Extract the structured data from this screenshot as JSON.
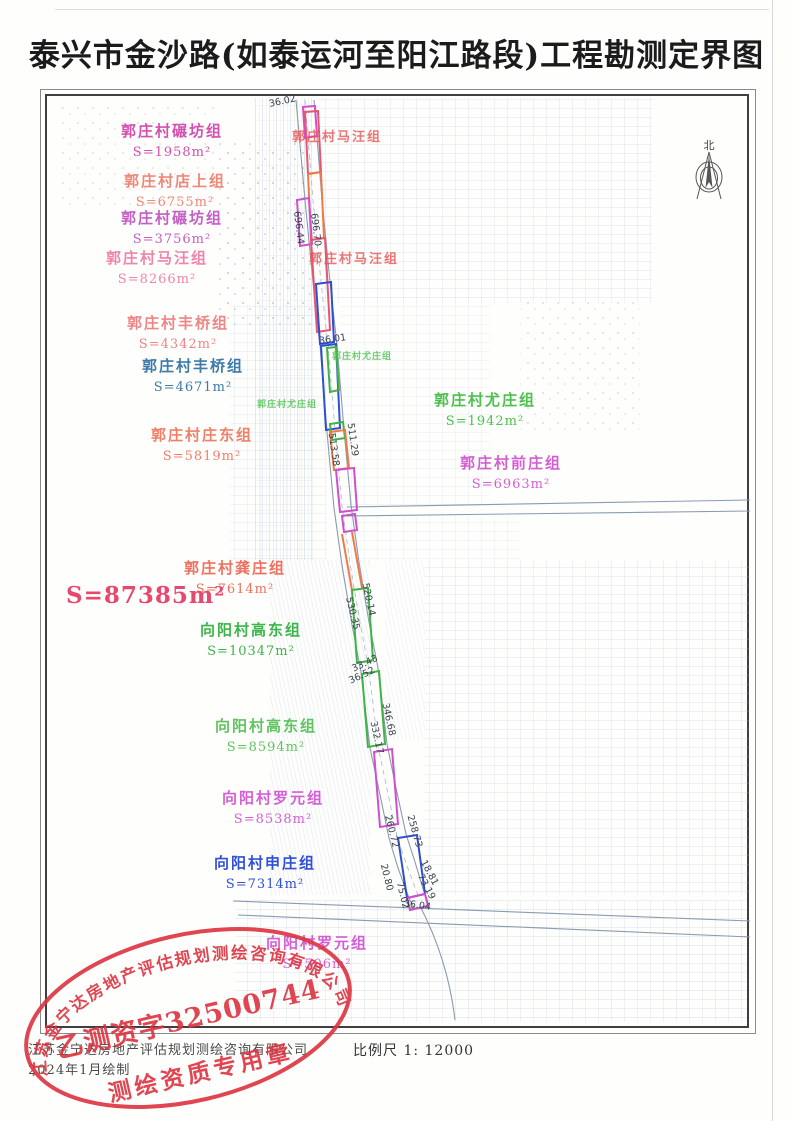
{
  "title": "泰兴市金沙路(如泰运河至阳江路段)工程勘测定界图",
  "north_label": "北",
  "total_area": {
    "text": "S=87385m²",
    "color": "#e8486e"
  },
  "footer": {
    "company": "江苏金宁达房地产评估规划测绘咨询有限公司",
    "date": "2024年1月绘制",
    "scale_label": "比例尺 1: 12000"
  },
  "stamp": {
    "arc_text": "江苏金宁达房地产评估规划测绘咨询有限公司",
    "center_text": "乙测资字32500744",
    "bottom_text": "测绘资质专用章",
    "color": "#dd3340"
  },
  "map": {
    "palette": {
      "magenta": "#cf4fcf",
      "red": "#e8556e",
      "orange": "#f07a45",
      "blue": "#2e4fd2",
      "green": "#41b344",
      "road": "#8a9bb0",
      "total": "#e8486e",
      "stamp": "#dd3340"
    },
    "area_labels": [
      {
        "name": "郭庄村碾坊组",
        "area": "S=1958m²",
        "color": "#d44fb0",
        "x": 172,
        "y": 120
      },
      {
        "name": "郭庄村店上组",
        "area": "S=6755m²",
        "color": "#ef8878",
        "x": 175,
        "y": 170
      },
      {
        "name": "郭庄村碾坊组",
        "area": "S=3756m²",
        "color": "#c45fc4",
        "x": 172,
        "y": 207
      },
      {
        "name": "郭庄村马汪组",
        "area": "S=8266m²",
        "color": "#ef85a8",
        "x": 157,
        "y": 247
      },
      {
        "name": "郭庄村丰桥组",
        "area": "S=4342m²",
        "color": "#ef8585",
        "x": 178,
        "y": 312
      },
      {
        "name": "郭庄村丰桥组",
        "area": "S=4671m²",
        "color": "#3d7ba8",
        "x": 193,
        "y": 355
      },
      {
        "name": "郭庄村庄东组",
        "area": "S=5819m²",
        "color": "#f0806a",
        "x": 202,
        "y": 424
      },
      {
        "name": "郭庄村龚庄组",
        "area": "S=7614m²",
        "color": "#f0705f",
        "x": 235,
        "y": 557
      },
      {
        "name": "向阳村高东组",
        "area": "S=10347m²",
        "color": "#3cb54a",
        "x": 251,
        "y": 619
      },
      {
        "name": "向阳村高东组",
        "area": "S=8594m²",
        "color": "#5fc45f",
        "x": 266,
        "y": 715
      },
      {
        "name": "向阳村罗元组",
        "area": "S=8538m²",
        "color": "#d45fd4",
        "x": 273,
        "y": 787
      },
      {
        "name": "向阳村申庄组",
        "area": "S=7314m²",
        "color": "#3050d8",
        "x": 265,
        "y": 852
      },
      {
        "name": "向阳村罗元组",
        "area": "S=506m²",
        "color": "#d45fd4",
        "x": 317,
        "y": 932
      },
      {
        "name": "郭庄村尤庄组",
        "area": "S=1942m²",
        "color": "#4cc14c",
        "x": 485,
        "y": 389
      },
      {
        "name": "郭庄村前庄组",
        "area": "S=6963m²",
        "color": "#d45fd4",
        "x": 511,
        "y": 452
      }
    ],
    "onmap_labels": [
      {
        "text": "郭庄村马汪组",
        "color": "#e85555",
        "x": 337,
        "y": 126,
        "small": false
      },
      {
        "text": "郭庄村马汪组",
        "color": "#e85555",
        "x": 354,
        "y": 248,
        "small": false
      },
      {
        "text": "郭庄村尤庄组",
        "color": "#4cc14c",
        "x": 362,
        "y": 349,
        "small": true
      },
      {
        "text": "郭庄村尤庄组",
        "color": "#4cc14c",
        "x": 287,
        "y": 397,
        "small": true
      }
    ],
    "measurements": [
      {
        "v": "36.02",
        "x": 283,
        "y": 104,
        "r": -12
      },
      {
        "v": "696.44",
        "x": 296,
        "y": 228,
        "r": 83
      },
      {
        "v": "696.70",
        "x": 313,
        "y": 230,
        "r": 83
      },
      {
        "v": "36.01",
        "x": 333,
        "y": 342,
        "r": -8
      },
      {
        "v": "513.58",
        "x": 331,
        "y": 450,
        "r": 82
      },
      {
        "v": "511.29",
        "x": 350,
        "y": 440,
        "r": 82
      },
      {
        "v": "530.35",
        "x": 350,
        "y": 614,
        "r": 76
      },
      {
        "v": "520.14",
        "x": 366,
        "y": 600,
        "r": 78
      },
      {
        "v": "33.43",
        "x": 366,
        "y": 666,
        "r": -25
      },
      {
        "v": "36.52",
        "x": 363,
        "y": 678,
        "r": -25
      },
      {
        "v": "332.17",
        "x": 374,
        "y": 738,
        "r": 78
      },
      {
        "v": "346.68",
        "x": 386,
        "y": 720,
        "r": 78
      },
      {
        "v": "260.72",
        "x": 389,
        "y": 832,
        "r": 76
      },
      {
        "v": "258.73",
        "x": 412,
        "y": 832,
        "r": 74
      },
      {
        "v": "20.80",
        "x": 384,
        "y": 878,
        "r": 76
      },
      {
        "v": "75.02",
        "x": 400,
        "y": 896,
        "r": 76
      },
      {
        "v": "18.81",
        "x": 427,
        "y": 874,
        "r": 62
      },
      {
        "v": "73.19",
        "x": 424,
        "y": 888,
        "r": 62
      },
      {
        "v": "36.04",
        "x": 417,
        "y": 908,
        "r": 8
      }
    ]
  }
}
